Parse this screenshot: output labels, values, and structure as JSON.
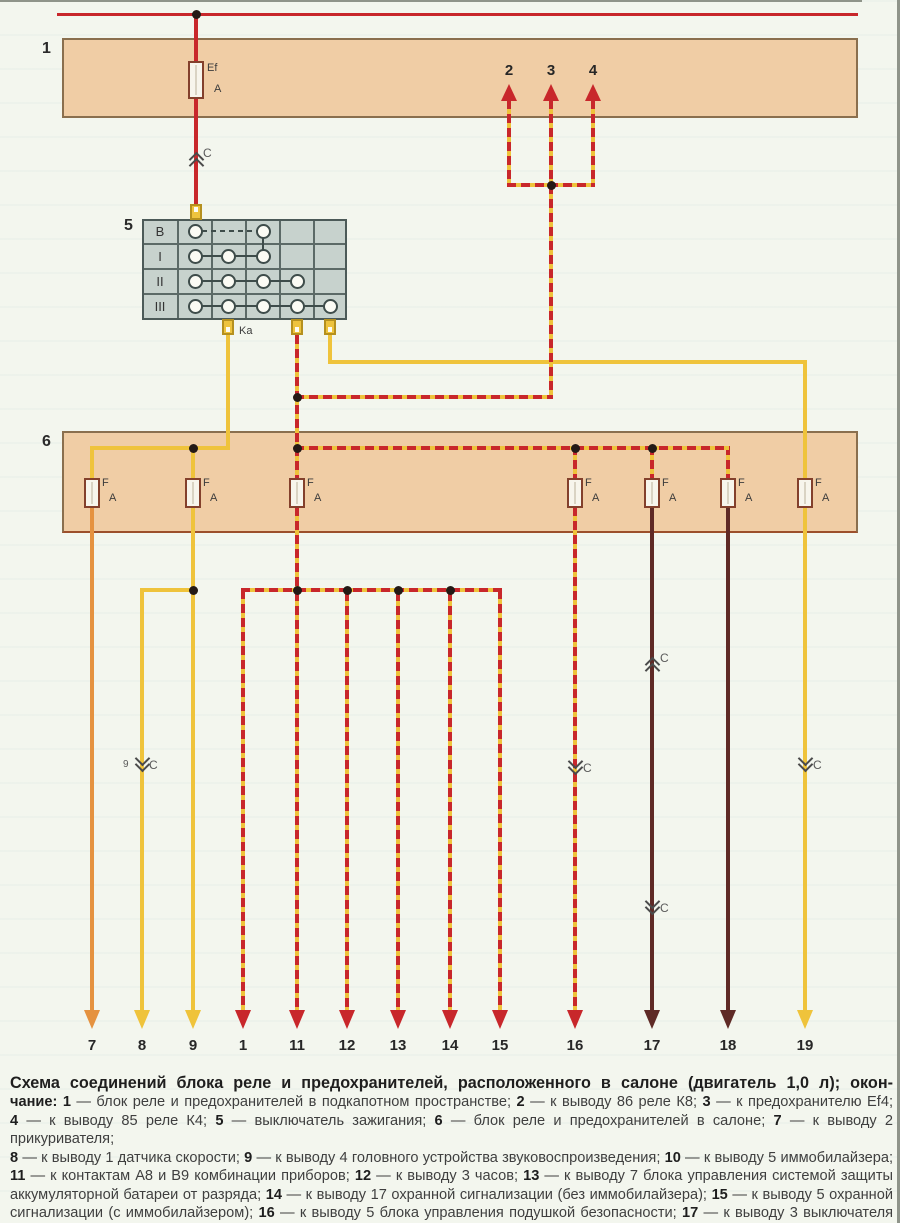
{
  "diagram": {
    "band1_label": "1",
    "band6_label": "6",
    "block5_label": "5",
    "ignition_rows": [
      "B",
      "I",
      "II",
      "III"
    ],
    "ka_label": "Ka",
    "fuse_main_label": "Ef",
    "fuse_f_label": "F",
    "fuse_amp_label": "A",
    "connector_mark": "C",
    "wire8_mark_number": "9",
    "top_terminals": [
      "2",
      "3",
      "4"
    ],
    "bottom_terminals": [
      "7",
      "8",
      "9",
      "1",
      "11",
      "12",
      "13",
      "14",
      "15",
      "16",
      "17",
      "18",
      "19"
    ]
  },
  "colors": {
    "wire_red": "#c8272b",
    "wire_yellow": "#efc33b",
    "wire_orange": "#e59240",
    "wire_dark": "#5f2a26",
    "band_fill": "#f0cda5",
    "band_border": "#8a6f4e",
    "switch_fill": "#c7d2cd"
  },
  "caption": {
    "lines": [
      {
        "style": "title",
        "segments": [
          {
            "t": "Схема соединений блока реле и предохранителей, расположенного в салоне (двигатель 1,0 л); окон-",
            "b": true
          }
        ]
      },
      {
        "style": "body",
        "segments": [
          {
            "t": "чание: ",
            "b": true
          },
          {
            "t": "1",
            "b": true
          },
          {
            "t": " — блок реле и предохранителей в подкапотном пространстве; ",
            "b": false
          },
          {
            "t": "2",
            "b": true
          },
          {
            "t": " — к выводу 86 реле К8; ",
            "b": false
          },
          {
            "t": "3",
            "b": true
          },
          {
            "t": " — к предохранителю Ef4;",
            "b": false
          }
        ]
      },
      {
        "style": "body",
        "segments": [
          {
            "t": "4",
            "b": true
          },
          {
            "t": " — к выводу 85 реле К4; ",
            "b": false
          },
          {
            "t": "5",
            "b": true
          },
          {
            "t": " — выключатель зажигания; ",
            "b": false
          },
          {
            "t": "6",
            "b": true
          },
          {
            "t": " — блок реле и предохранителей в салоне; ",
            "b": false
          },
          {
            "t": "7",
            "b": true
          },
          {
            "t": " — к выводу 2 прикуривателя;",
            "b": false
          }
        ]
      },
      {
        "style": "body",
        "segments": [
          {
            "t": "8",
            "b": true
          },
          {
            "t": " — к выводу 1 датчика скорости; ",
            "b": false
          },
          {
            "t": "9",
            "b": true
          },
          {
            "t": " — к выводу 4 головного устройства звуковоспроизведения; ",
            "b": false
          },
          {
            "t": "10",
            "b": true
          },
          {
            "t": " — к выводу 5 иммобилайзера;",
            "b": false
          }
        ]
      },
      {
        "style": "body",
        "segments": [
          {
            "t": "11",
            "b": true
          },
          {
            "t": " — к контактам А8 и В9 комбинации приборов; ",
            "b": false
          },
          {
            "t": "12",
            "b": true
          },
          {
            "t": " — к выводу 3 часов; ",
            "b": false
          },
          {
            "t": "13",
            "b": true
          },
          {
            "t": " — к выводу 7 блока управления системой защиты",
            "b": false
          }
        ]
      },
      {
        "style": "body",
        "segments": [
          {
            "t": "аккумуляторной батареи от разряда; ",
            "b": false
          },
          {
            "t": "14",
            "b": true
          },
          {
            "t": " — к выводу 17 охранной сигнализации (без иммобилайзера); ",
            "b": false
          },
          {
            "t": "15",
            "b": true
          },
          {
            "t": " — к выводу 5 охранной",
            "b": false
          }
        ]
      },
      {
        "style": "body",
        "segments": [
          {
            "t": "сигнализации (с иммобилайзером); ",
            "b": false
          },
          {
            "t": "16",
            "b": true
          },
          {
            "t": " — к выводу 5 блока управления подушкой безопасности; ",
            "b": false
          },
          {
            "t": "17",
            "b": true
          },
          {
            "t": " — к выводу 3 выключателя сте-",
            "b": false
          }
        ]
      },
      {
        "style": "last",
        "segments": [
          {
            "t": "клоподъемников левой передней двери; ",
            "b": false
          },
          {
            "t": "18",
            "b": true
          },
          {
            "t": " — к выводу 10 выключателя аварийной сигнализации; ",
            "b": false
          },
          {
            "t": "19",
            "b": true
          },
          {
            "t": " — к стартеру",
            "b": false
          }
        ]
      }
    ]
  }
}
